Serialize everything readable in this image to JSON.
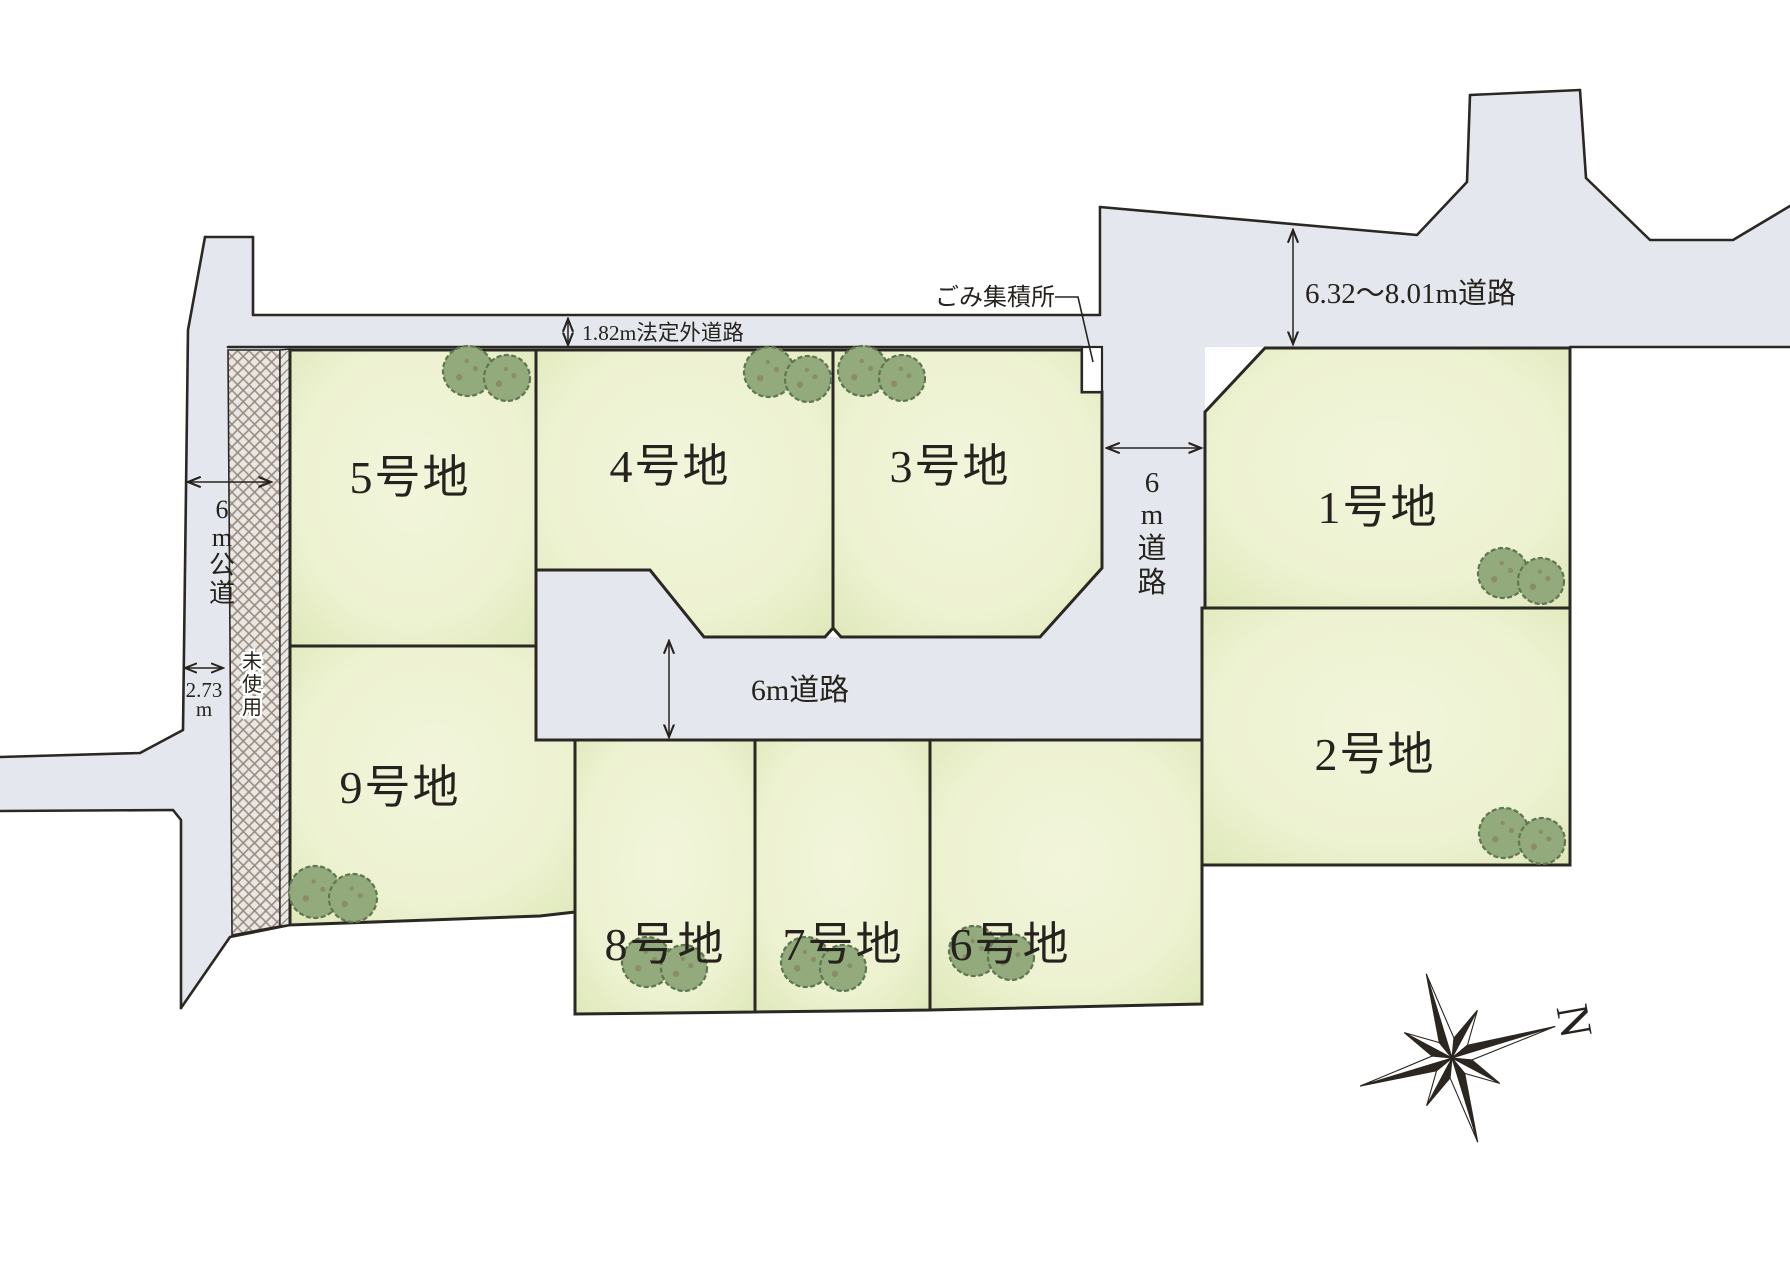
{
  "map_title": "宅地分譲 区画図",
  "lots": [
    {
      "id": 1,
      "label": "1号地"
    },
    {
      "id": 2,
      "label": "2号地"
    },
    {
      "id": 3,
      "label": "3号地"
    },
    {
      "id": 4,
      "label": "4号地"
    },
    {
      "id": 5,
      "label": "5号地"
    },
    {
      "id": 6,
      "label": "6号地"
    },
    {
      "id": 7,
      "label": "7号地"
    },
    {
      "id": 8,
      "label": "8号地"
    },
    {
      "id": 9,
      "label": "9号地"
    }
  ],
  "annotations": {
    "narrow_road": "1.82m法定外道路",
    "garbage": "ごみ集積所",
    "road_ne": "6.32〜8.01m道路",
    "road_right_vertical": {
      "c1": "6",
      "c2": "m",
      "c3": "道",
      "c4": "路"
    },
    "road_mid": "6m道路",
    "road_left_vertical": {
      "c1": "6",
      "c2": "m",
      "c3": "公",
      "c4": "道"
    },
    "dim_273": {
      "value": "2.73",
      "unit": "m"
    },
    "unused": {
      "c1": "未",
      "c2": "使",
      "c3": "用"
    },
    "compass_n": "N"
  },
  "colors": {
    "road": "#e4e8ee",
    "lot_fill": "#ecf1cf",
    "lot_edge_shade": "#d8e3ae",
    "outline": "#2b2823",
    "tree": "#93ab7c",
    "hatch_line": "#99897c"
  }
}
